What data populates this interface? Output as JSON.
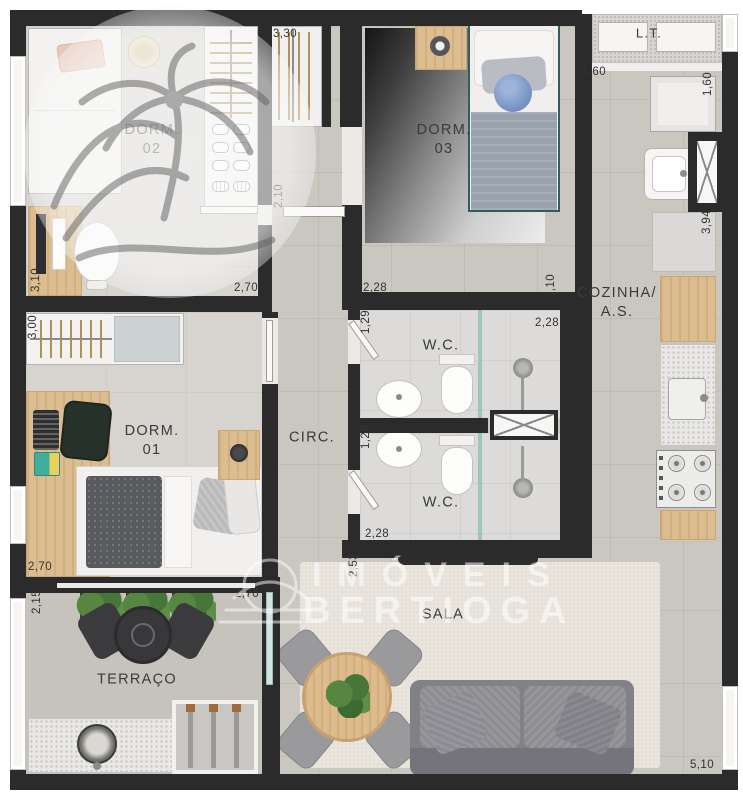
{
  "plan": {
    "rooms": {
      "dorm02": "DORM.\n02",
      "dorm03": "DORM.\n03",
      "dorm01": "DORM.\n01",
      "cozinha": "COZINHA/\nA.S.",
      "wc_top": "W.C.",
      "wc_bottom": "W.C.",
      "circ": "CIRC.",
      "sala": "SALA",
      "terraco": "TERRAÇO",
      "lt": "L.T."
    },
    "dims": {
      "closet_entry": "3,30",
      "dorm02_side": "2,10",
      "dorm02_width": "2,70",
      "dorm02_depth": "3,10",
      "dorm01_closet": "3,00",
      "dorm01_width": "2,70",
      "terraco_depth": "2,15",
      "terraco_width": "2,70",
      "dorm03_width": "2,28",
      "dorm03_depth": "3,10",
      "wc_top_depth": "1,29",
      "wc_top_width": "2,28",
      "wc_bottom_depth": "1,29",
      "wc_bottom_width": "2,28",
      "sala_side": "2,53",
      "cozinha_width": "1,60",
      "cozinha_width_r": "1,60",
      "cozinha_depth": "3,94",
      "sala_width": "5,10"
    },
    "watermark": {
      "line1": "IMÓVEIS",
      "line2": "BERTIOGA"
    },
    "colors": {
      "wall": "#2b2b2c",
      "floor_tile": "#cac6c0",
      "wood": "#dcbd90",
      "shower_glass": "#9ccbc3",
      "bed_cushion_blue": "#7b97c6"
    }
  }
}
